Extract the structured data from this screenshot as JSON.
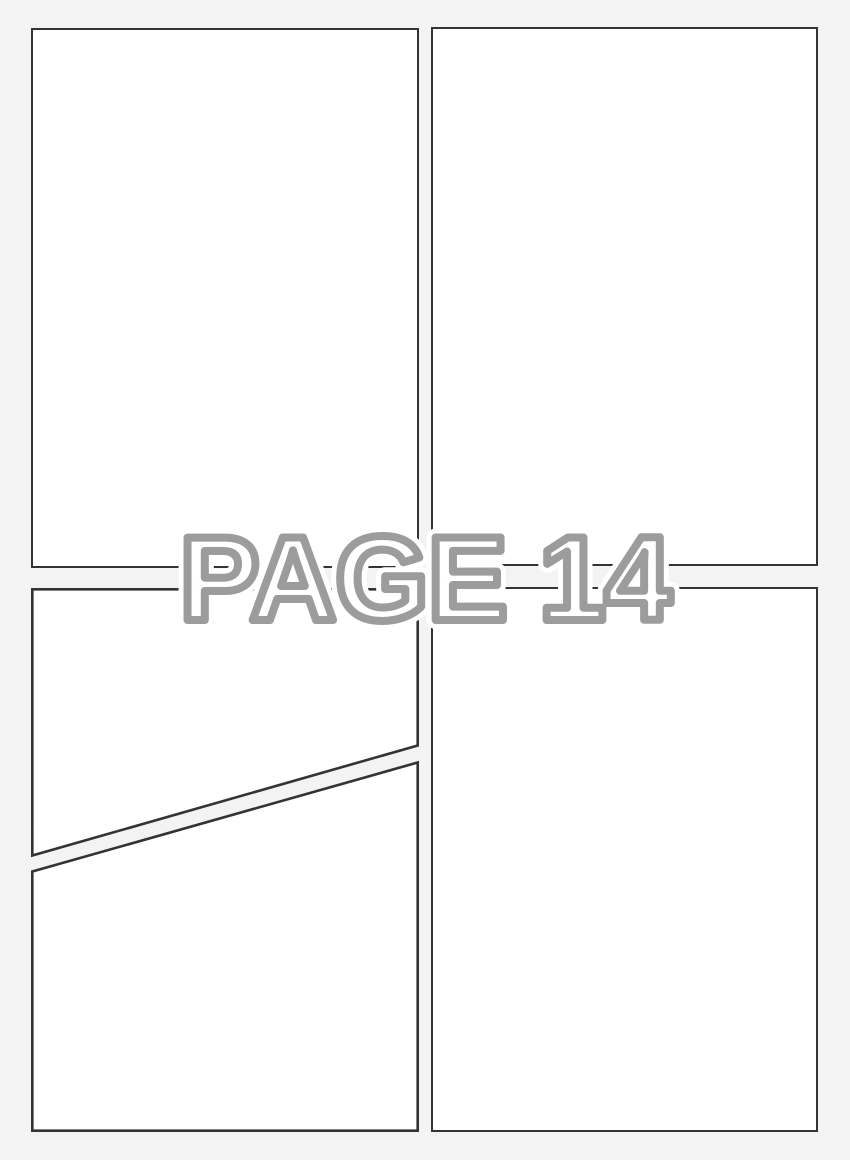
{
  "page_label": {
    "text": "PAGE 14",
    "fill_color": "#ffffff",
    "outline_color": "#9c9c9c",
    "halo_color": "#ffffff"
  },
  "canvas": {
    "background_color": "#f3f3f3",
    "panel_fill_color": "#ffffff",
    "panel_border_color": "#333333"
  },
  "panels": [
    {
      "id": "top-left",
      "shape": "rectangle",
      "content": ""
    },
    {
      "id": "top-right",
      "shape": "rectangle",
      "content": ""
    },
    {
      "id": "bottom-left-upper",
      "shape": "slanted-bottom",
      "content": ""
    },
    {
      "id": "bottom-left-lower",
      "shape": "slanted-top",
      "content": ""
    },
    {
      "id": "bottom-right",
      "shape": "rectangle",
      "content": ""
    }
  ]
}
